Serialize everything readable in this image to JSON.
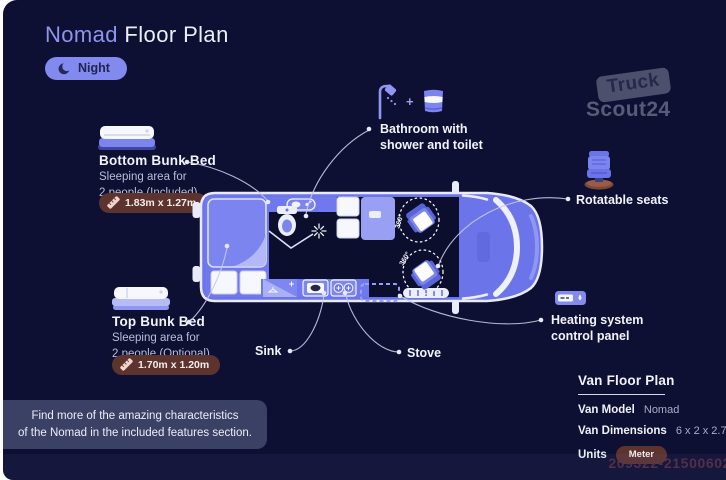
{
  "title": {
    "brand": "Nomad",
    "rest": " Floor Plan"
  },
  "mode": {
    "label": "Night"
  },
  "brand_logo": {
    "top": "Truck",
    "bottom": "Scout24"
  },
  "callouts": {
    "bottom_bunk": {
      "title": "Bottom Bunk Bed",
      "desc1": "Sleeping area for",
      "desc2": "2 people (Included)",
      "dimensions": "1.83m x 1.27m"
    },
    "top_bunk": {
      "title": "Top Bunk Bed",
      "desc1": "Sleeping area for",
      "desc2": "2 people (Optional)",
      "dimensions": "1.70m x 1.20m"
    },
    "bathroom": {
      "plus": "+",
      "line1": "Bathroom with",
      "line2": "shower and toilet"
    },
    "rotatable_seats": {
      "label": "Rotatable seats"
    },
    "heating": {
      "line1": "Heating system",
      "line2": "control panel"
    },
    "sink": {
      "label": "Sink"
    },
    "stove": {
      "label": "Stove"
    }
  },
  "van": {
    "rotation_label": "360°"
  },
  "note": {
    "line1": "Find more of the amazing characteristics",
    "line2": "of the Nomad in the included features section."
  },
  "spec_panel": {
    "heading": "Van Floor Plan",
    "model_label": "Van Model",
    "model_value": "Nomad",
    "dimensions_label": "Van Dimensions",
    "dimensions_value": "6 x 2 x 2.75 m",
    "units_label": "Units",
    "units_value": "Meter"
  },
  "listing_id": "209322-21500602",
  "colors": {
    "background": "#0e1033",
    "accent": "#7b84ea",
    "badge": "#5d332e",
    "panel": "#3b4065",
    "text_primary": "#f2f3fa",
    "text_secondary": "#b9bed9"
  }
}
